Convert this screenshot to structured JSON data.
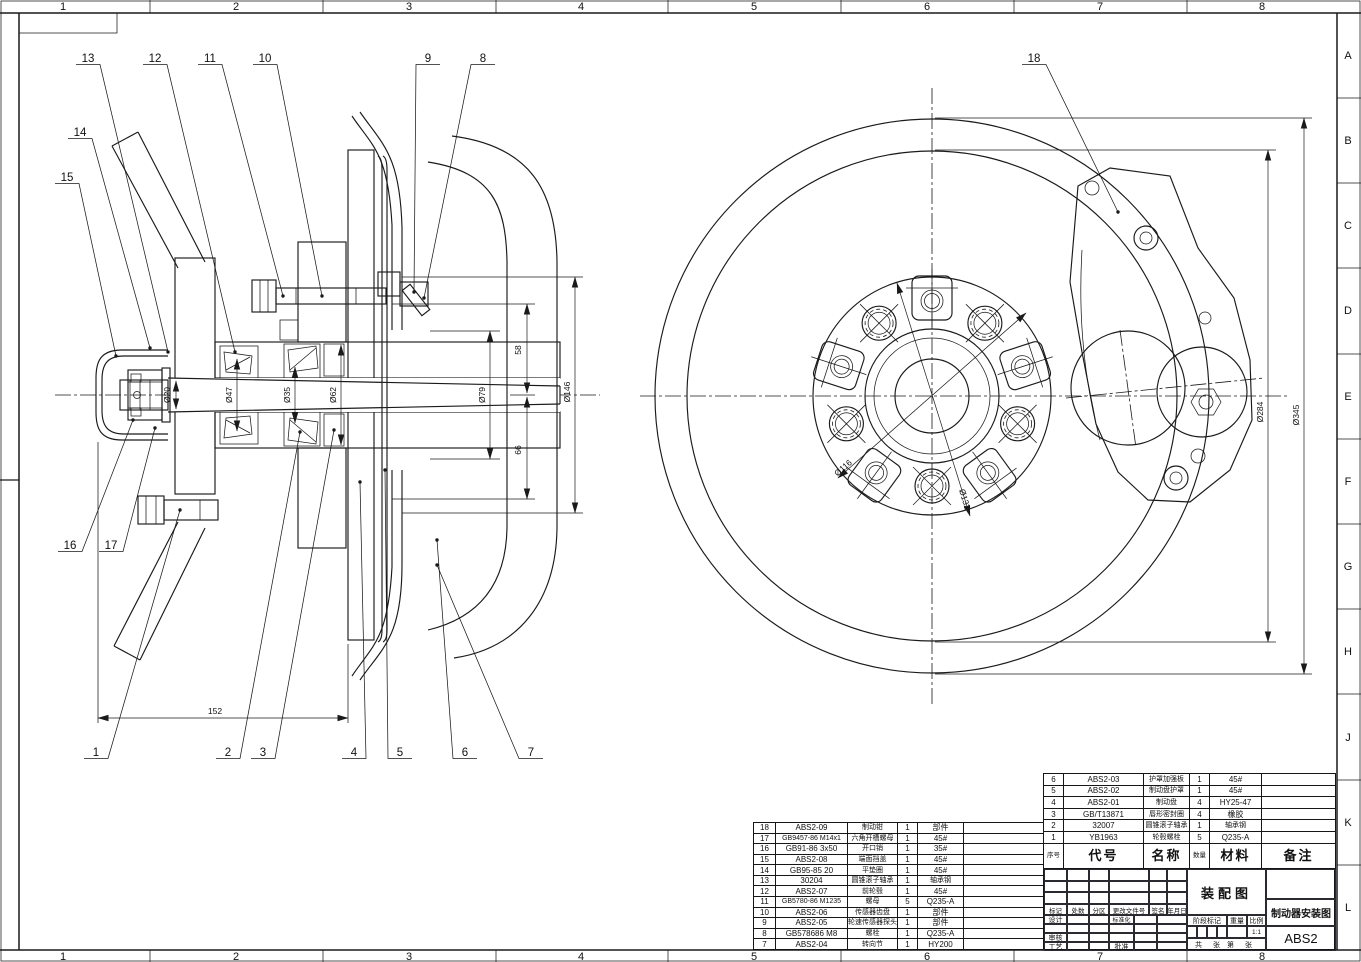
{
  "sheet": {
    "cols": [
      "1",
      "2",
      "3",
      "4",
      "5",
      "6",
      "7",
      "8"
    ],
    "rows": [
      "A",
      "B",
      "C",
      "D",
      "E",
      "F",
      "G",
      "H",
      "J",
      "K",
      "L"
    ]
  },
  "balloons": [
    "1",
    "2",
    "3",
    "4",
    "5",
    "6",
    "7",
    "8",
    "9",
    "10",
    "11",
    "12",
    "13",
    "14",
    "15",
    "16",
    "17",
    "18"
  ],
  "dims": {
    "d20": "Ø20",
    "d47": "Ø47",
    "d35": "Ø35",
    "d62": "Ø62",
    "d58": "58",
    "d66": "66",
    "d79": "Ø79",
    "d146": "Ø146",
    "d152": "152",
    "d116": "Ø116",
    "d132": "Ø132",
    "d284": "Ø284",
    "d345": "Ø345"
  },
  "bom": {
    "header": {
      "no": "序号",
      "code": "代号",
      "name": "名称",
      "qty": "数量",
      "material": "材料",
      "note": "备注"
    },
    "left_rows": [
      {
        "no": "18",
        "code": "ABS2-09",
        "name": "制动钳",
        "qty": "1",
        "material": "部件",
        "note": ""
      },
      {
        "no": "17",
        "code": "GB9457-86 M14x1",
        "name": "六角开槽螺母",
        "qty": "1",
        "material": "45#",
        "note": ""
      },
      {
        "no": "16",
        "code": "GB91-86 3x50",
        "name": "开口销",
        "qty": "1",
        "material": "35#",
        "note": ""
      },
      {
        "no": "15",
        "code": "ABS2-08",
        "name": "端面挡盖",
        "qty": "1",
        "material": "45#",
        "note": ""
      },
      {
        "no": "14",
        "code": "GB95-85 20",
        "name": "平垫圈",
        "qty": "1",
        "material": "45#",
        "note": ""
      },
      {
        "no": "13",
        "code": "30204",
        "name": "圆锥滚子轴承",
        "qty": "1",
        "material": "轴承钢",
        "note": ""
      },
      {
        "no": "12",
        "code": "ABS2-07",
        "name": "前轮毂",
        "qty": "1",
        "material": "45#",
        "note": ""
      },
      {
        "no": "11",
        "code": "GB5780-86 M1235",
        "name": "螺母",
        "qty": "5",
        "material": "Q235-A",
        "note": ""
      },
      {
        "no": "10",
        "code": "ABS2-06",
        "name": "传感器齿盘",
        "qty": "1",
        "material": "部件",
        "note": ""
      },
      {
        "no": "9",
        "code": "ABS2-05",
        "name": "轮速传感器探头",
        "qty": "1",
        "material": "部件",
        "note": ""
      },
      {
        "no": "8",
        "code": "GB578686 M8",
        "name": "螺栓",
        "qty": "1",
        "material": "Q235-A",
        "note": ""
      },
      {
        "no": "7",
        "code": "ABS2-04",
        "name": "转向节",
        "qty": "1",
        "material": "HY200",
        "note": ""
      }
    ],
    "right_rows": [
      {
        "no": "6",
        "code": "ABS2-03",
        "name": "护罩加强板",
        "qty": "1",
        "material": "45#",
        "note": ""
      },
      {
        "no": "5",
        "code": "ABS2-02",
        "name": "制动盘护罩",
        "qty": "1",
        "material": "45#",
        "note": ""
      },
      {
        "no": "4",
        "code": "ABS2-01",
        "name": "制动盘",
        "qty": "4",
        "material": "HY25-47",
        "note": ""
      },
      {
        "no": "3",
        "code": "GB/T13871",
        "name": "唇形密封圈",
        "qty": "4",
        "material": "橡胶",
        "note": ""
      },
      {
        "no": "2",
        "code": "32007",
        "name": "圆锥滚子轴承",
        "qty": "1",
        "material": "轴承钢",
        "note": ""
      },
      {
        "no": "1",
        "code": "YB1963",
        "name": "轮毂螺栓",
        "qty": "5",
        "material": "Q235-A",
        "note": ""
      }
    ]
  },
  "title_block": {
    "assembly": "装配图",
    "title": "制动器安装图",
    "code": "ABS2",
    "scale_value": "1:1",
    "change_row": [
      "标记",
      "处数",
      "分区",
      "更改文件号",
      "签名",
      "年月日"
    ],
    "roles": {
      "design": "设计",
      "standard": "标准化",
      "audit": "审核",
      "process": "工艺",
      "approve": "批准"
    },
    "stage": "阶段标记",
    "weight": "重量",
    "scale": "比例",
    "sheet_note": [
      "共",
      "张",
      "第",
      "张"
    ]
  }
}
